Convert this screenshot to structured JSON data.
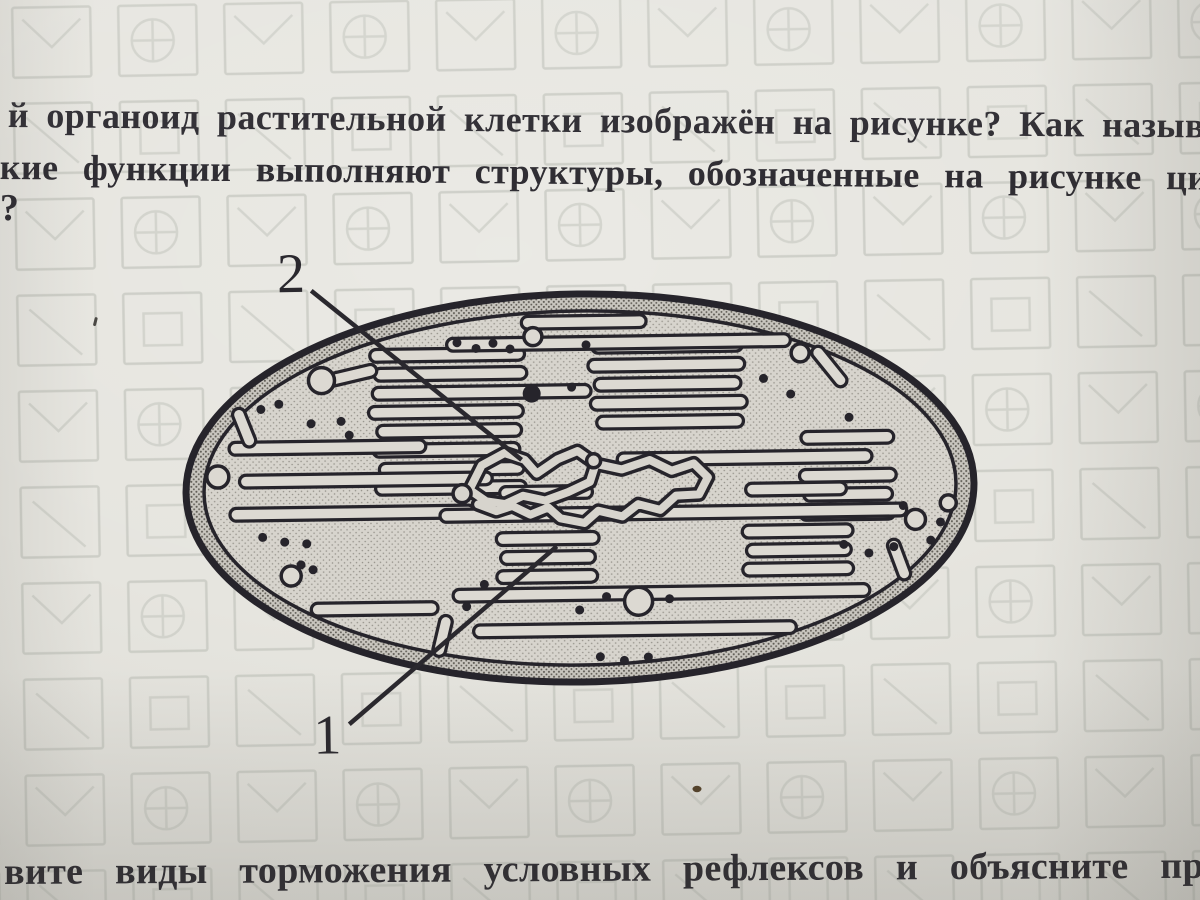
{
  "question_top": {
    "line1": "й органоид растительной клетки изображён на рисунке? Как называю",
    "line2": "кие функции выполняют структуры, обозначенные на рисунке цифра",
    "line3": "?"
  },
  "figure": {
    "name": "chloroplast-diagram",
    "label_1": "1",
    "label_2": "2"
  },
  "question_bottom": {
    "line1": "вите виды торможения условных рефлексов и объясните причины и",
    "line2": "икновения"
  },
  "colors": {
    "paper": "#e6e5df",
    "ink": "#2f2d33",
    "figure_ink": "#26242b",
    "watermark": "#b9bcb4"
  }
}
